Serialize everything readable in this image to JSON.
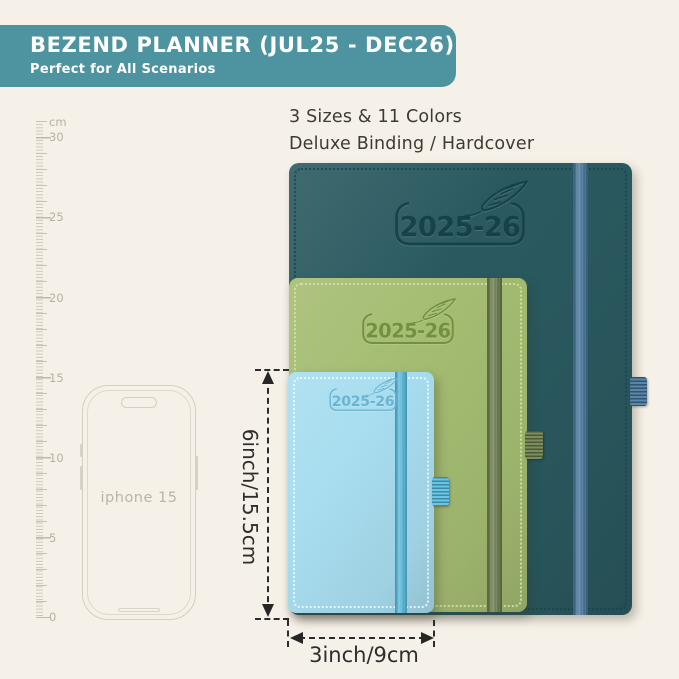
{
  "page": {
    "background": "#f6f1e8"
  },
  "banner": {
    "title": "BEZEND PLANNER (JUL25 - DEC26)",
    "subtitle": "Perfect for All Scenarios",
    "background": "#4e93a0",
    "text_color": "#ffffff"
  },
  "intro": {
    "line1": "3 Sizes & 11 Colors",
    "line2": "Deluxe Binding / Hardcover"
  },
  "ruler": {
    "unit": "cm",
    "labels": [
      "30",
      "25",
      "20",
      "15",
      "10",
      "5",
      "0"
    ]
  },
  "phone": {
    "label": "iphone 15"
  },
  "planners": [
    {
      "size": "large",
      "year": "2025-26",
      "cover": "#2a5a60",
      "band": "#44759c",
      "stitch": "#1b454e",
      "logo_color": "#163f49",
      "loop": "#44759c"
    },
    {
      "size": "medium",
      "year": "2025-26",
      "cover": "#a5bd72",
      "band": "#6a7d49",
      "stitch": "#d6e3ab",
      "logo_color": "#6f8d3c",
      "loop": "#6a7d49"
    },
    {
      "size": "small",
      "year": "2025-26",
      "cover": "#a8def0",
      "band": "#55bee2",
      "stitch": "#ecfafd",
      "logo_color": "#66b2d0",
      "loop": "#55bee2"
    }
  ],
  "dimensions": {
    "height_label": "6inch/15.5cm",
    "width_label": "3inch/9cm"
  }
}
